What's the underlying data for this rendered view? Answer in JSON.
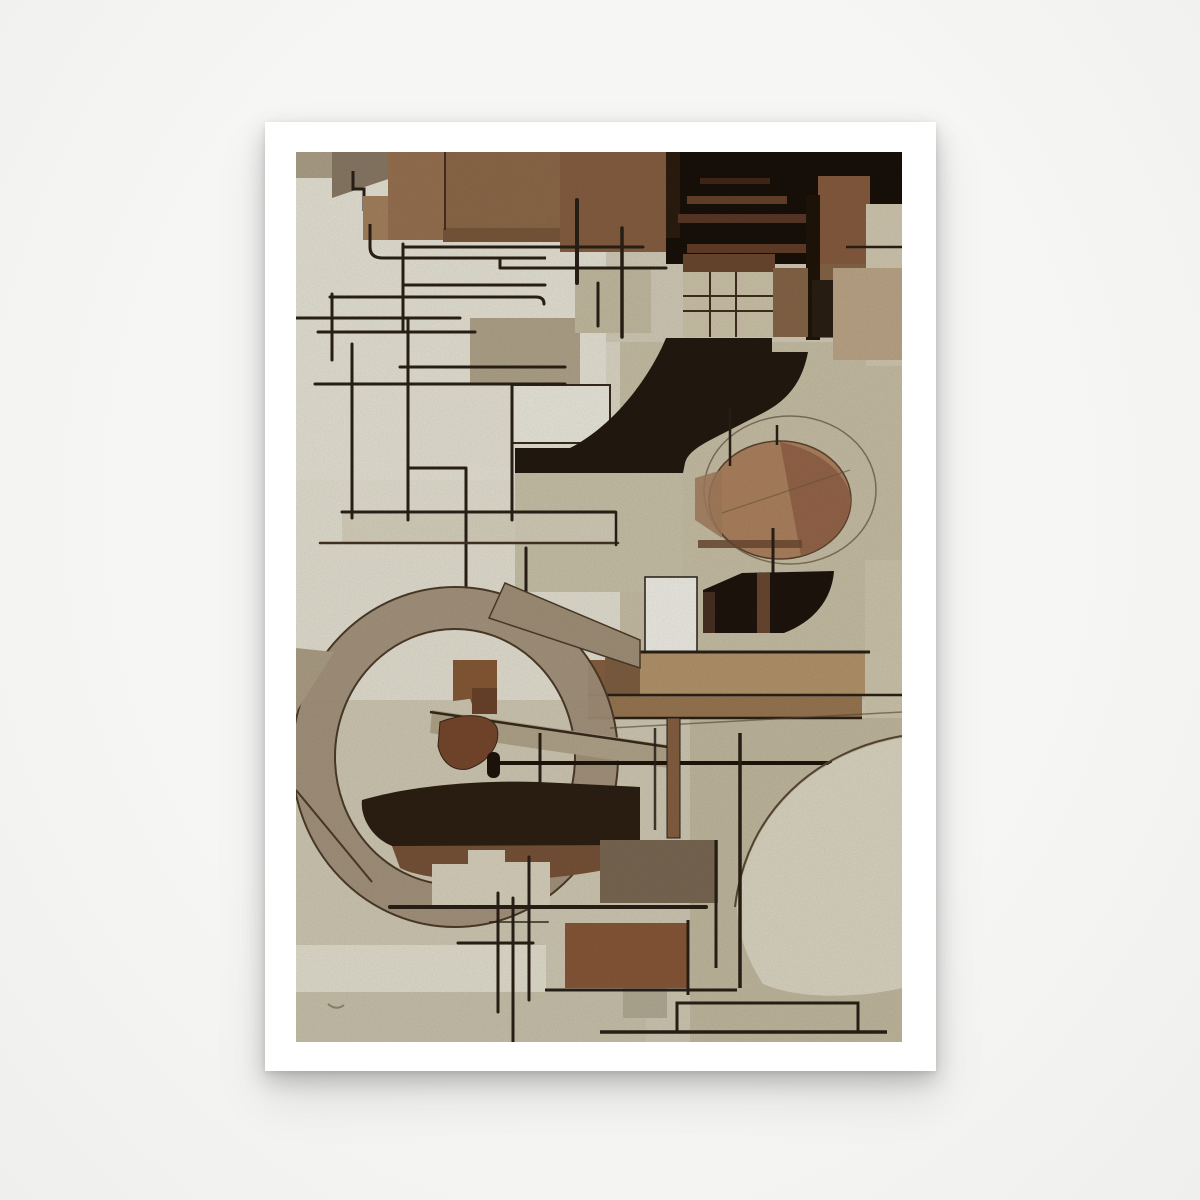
{
  "scene": {
    "background_color": "#f4f4f3",
    "type": "poster product photo"
  },
  "poster": {
    "paper_color": "#ffffff",
    "orientation": "portrait"
  },
  "artwork": {
    "description": "Abstract cubist composition in shades of brown, beige, black and ivory: rectangular blocks, thin black line lattice, a large dark S-curve, a tan circle, a big taupe elliptical ring and a dark hull shape.",
    "style": "cubism / constructivist abstraction",
    "palette": {
      "ivory": "#edeadb",
      "beige": "#e3ddcb",
      "khaki": "#cdc4a9",
      "taupe_ring": "#a6957d",
      "brown_main": "#9c7553",
      "brown_dark": "#8a6143",
      "sienna": "#8c5a3a",
      "stripe_brown": "#6a432c",
      "near_black": "#19110a",
      "line_ink": "#2b2117",
      "circle_tan": "#b28662",
      "circle_shadow": "#966549"
    },
    "elements": [
      "top brown block field",
      "black corner with brown stripes",
      "window grid block",
      "thin line lattice",
      "black s-curve",
      "tan circle with sketch ellipse",
      "black quarter fan",
      "tan horizontal bars",
      "large elliptical ring",
      "dark hull wedge",
      "bottom line grid",
      "pale corner fan"
    ]
  }
}
